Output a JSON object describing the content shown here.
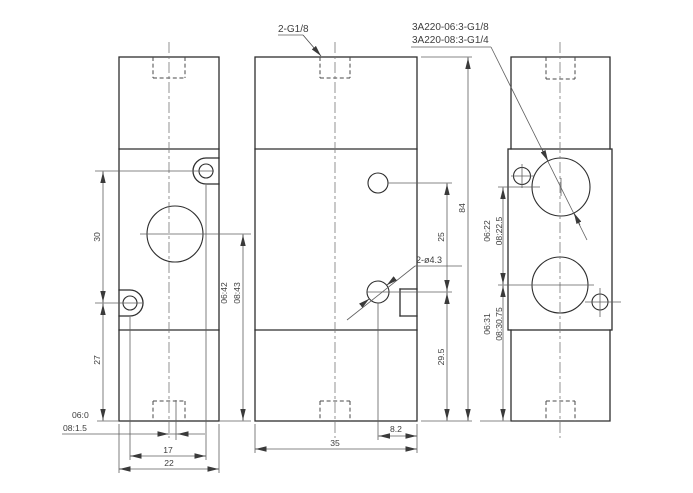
{
  "colors": {
    "background": "#ffffff",
    "line": "#2e2e2e",
    "dim_line": "#5f5f5f",
    "text": "#3d3d3d"
  },
  "callouts": {
    "top_port": "2-G1/8",
    "model_spec_line1": "3A220-06:3-G1/8",
    "model_spec_line2": "3A220-08:3-G1/4",
    "mounting_holes": "2-ø4.3"
  },
  "left_view": {
    "dim_hole_spacing_vertical": "30",
    "dim_hole_to_bottom": "27",
    "dim_hole_spacing_horizontal": "17",
    "dim_width": "22",
    "port_offset_06": "06:0",
    "port_offset_08": "08:1.5",
    "dim_center_height_06": "06:42",
    "dim_center_height_08": "08:43"
  },
  "middle_view": {
    "dim_depth": "35",
    "dim_port_to_edge": "8.2",
    "dim_hole_spacing": "25",
    "dim_hole_height": "29.5",
    "dim_total_height": "84"
  },
  "right_view": {
    "dim_port_spacing_06": "06:22",
    "dim_port_spacing_08": "08:22.5",
    "dim_port_height_06": "06:31",
    "dim_port_height_08": "08:30.75"
  }
}
